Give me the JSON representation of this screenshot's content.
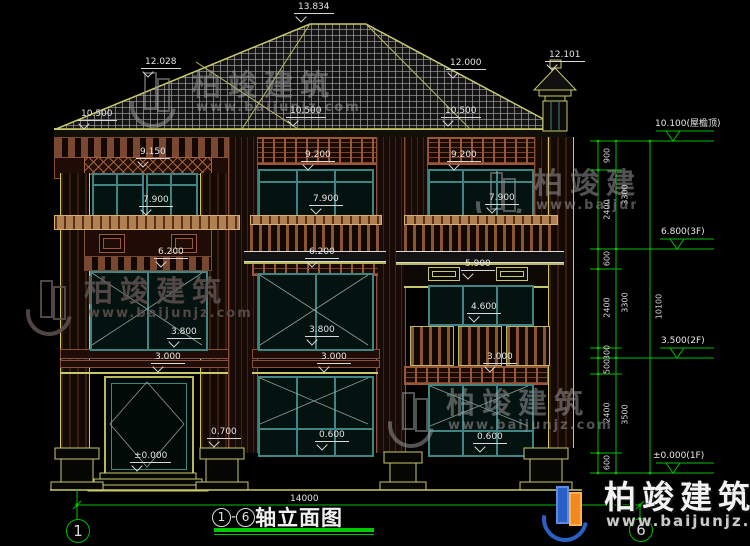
{
  "drawing": {
    "marks": {
      "ridge": "13.834",
      "hip_left": "12.028",
      "hip_right": "12.000",
      "chimney": "12.101",
      "eave_left": "10.500",
      "eave_mid": "10.500",
      "eave_right": "10.500",
      "band_left": "9.150",
      "band_mid": "9.200",
      "band_right": "9.200",
      "sill3f_left": "7.900",
      "sill3f_mid": "7.900",
      "sill3f_right": "7.900",
      "floor_left": "6.200",
      "floor_mid": "6.200",
      "band_2f_right": "5.900",
      "sill2f_right": "4.600",
      "sill2f_left": "3.800",
      "sill2f_mid": "3.800",
      "band_1f_left": "3.000",
      "band_1f_mid": "3.000",
      "band_1f_right": "3.000",
      "plinth": "0.700",
      "sill1f_mid": "0.600",
      "sill1f_right": "0.600",
      "door_level": "±0.000"
    },
    "levels": {
      "roof_top": "10.100(屋檐顶)",
      "f3": "6.800(3F)",
      "f2": "3.500(2F)",
      "f1": "±0.000(1F)"
    },
    "chain": {
      "c900": "900",
      "c2400": "2400",
      "c600": "600",
      "c300": "300",
      "c500": "500",
      "c3300": "3300",
      "c3500": "3500",
      "total": "10100"
    },
    "footer": {
      "overall_dim": "14000",
      "axis_left": "1",
      "axis_right": "6",
      "title_axis_from": "1",
      "title_dash": "-",
      "title_axis_to": "6",
      "title_text": "轴立面图"
    }
  },
  "watermark": {
    "name": "柏竣建筑",
    "url": "www.baijunjz.com"
  },
  "colors": {
    "line_green": "#00c000",
    "line_yellow": "#c9c96a",
    "frame_teal": "#3f8583",
    "band_maroon": "#8a5038",
    "text_white": "#e4e4e4"
  }
}
